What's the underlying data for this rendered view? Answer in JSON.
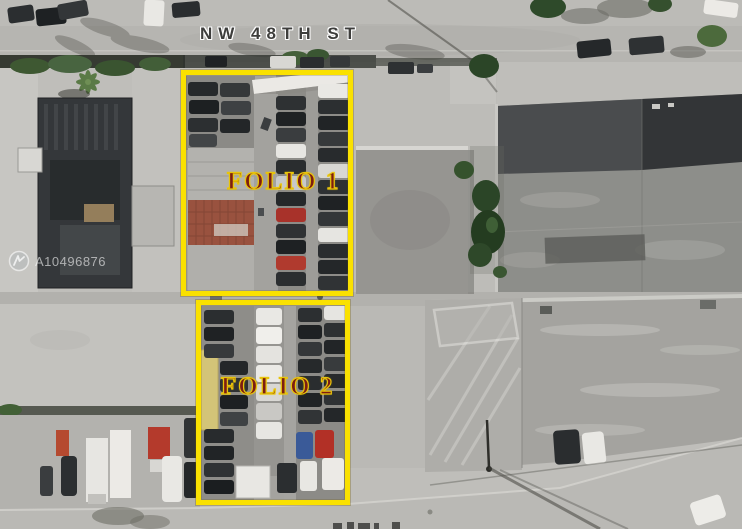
{
  "streets": {
    "top_label": "NW 48TH ST"
  },
  "parcels": [
    {
      "id": "folio1",
      "label": "FOLIO 1"
    },
    {
      "id": "folio2",
      "label": "FOLIO 2"
    }
  ],
  "watermark": {
    "text": "A10496876",
    "logo": "mls-swoosh-icon"
  },
  "colors": {
    "parcel_outline": "#fae100",
    "parcel_label_fill": "#7d1d12",
    "parcel_label_outline": "#e8c40a",
    "street_label": "#3e3e3c",
    "street_label_halo": "#ffffff",
    "watermark": "rgba(255,255,255,0.58)"
  }
}
